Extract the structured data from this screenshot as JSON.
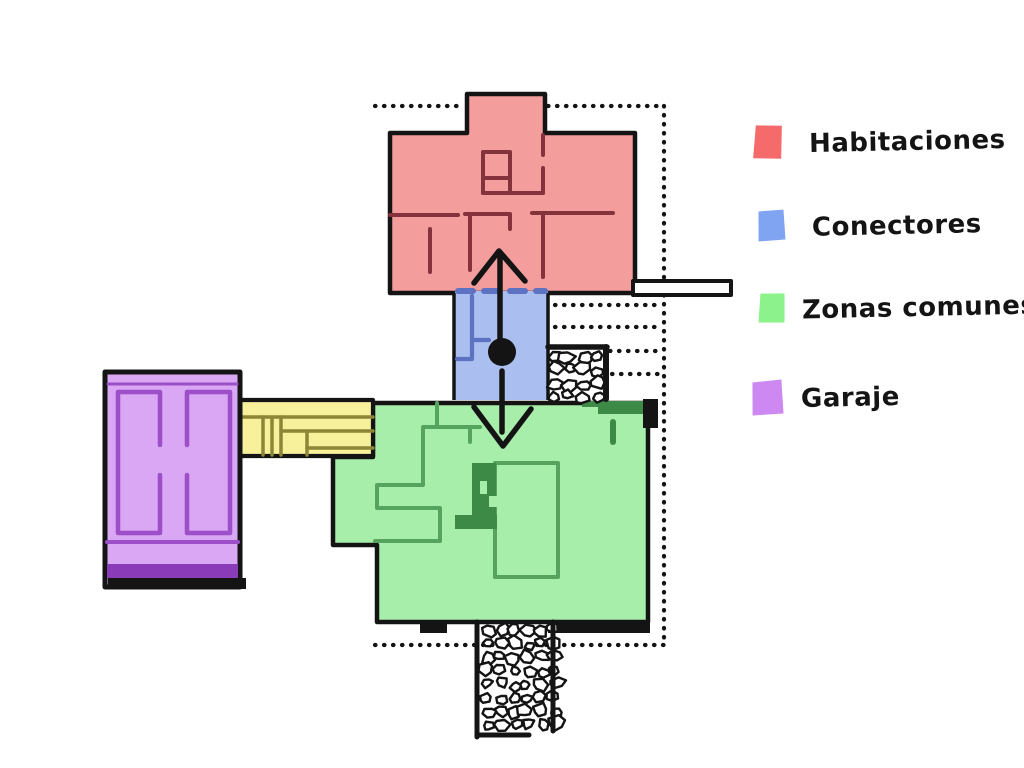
{
  "title": "Plano de zonas de la casa",
  "legend": {
    "items": [
      {
        "id": "habitaciones",
        "label": "Habitaciones",
        "color": "#f56a6a"
      },
      {
        "id": "conectores",
        "label": "Conectores",
        "color": "#80a4f2"
      },
      {
        "id": "zonas_comunes",
        "label": "Zonas comunes",
        "color": "#8cf28c"
      },
      {
        "id": "garaje",
        "label": "Garaje",
        "color": "#cd89f1"
      }
    ]
  },
  "plan": {
    "ink": "#141414",
    "paper": "#ffffff",
    "zones": {
      "habitaciones": {
        "fill": "#f49d9d",
        "wall": "#84323c"
      },
      "conectores": {
        "fill": "#abbef0",
        "wall": "#5e72c2"
      },
      "zonas_comunes": {
        "fill": "#a8eeab",
        "wall": "#56a35f",
        "dark": "#3c8a46"
      },
      "garaje": {
        "fill": "#d9a7f3",
        "wall": "#9d4ec9",
        "band": "#8a3cb8"
      },
      "pasillo": {
        "fill": "#f8f19b",
        "wall": "#8d8636"
      }
    }
  }
}
